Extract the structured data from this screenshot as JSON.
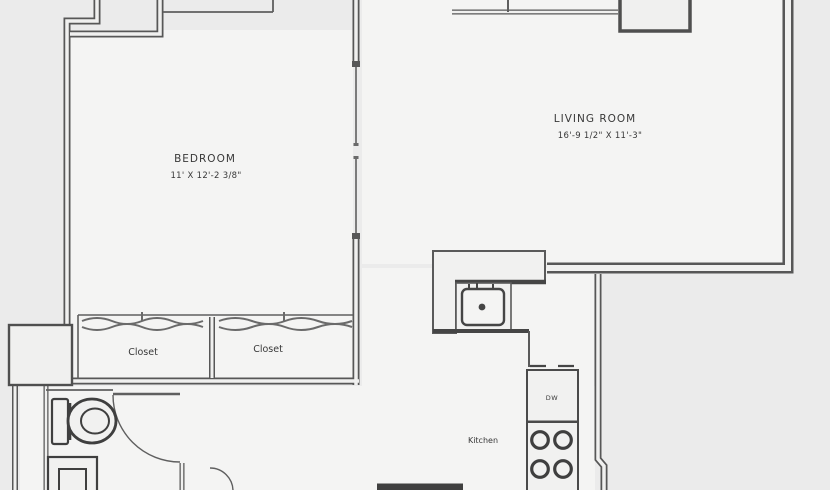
{
  "rooms": {
    "bedroom": {
      "label": "BEDROOM",
      "dimensions": "11' X 12'-2 3/8\""
    },
    "living_room": {
      "label": "LIVING ROOM",
      "dimensions": "16'-9 1/2\" X 11'-3\""
    },
    "closet_left": {
      "label": "Closet"
    },
    "closet_right": {
      "label": "Closet"
    },
    "kitchen": {
      "label": "Kitchen"
    }
  },
  "appliances": {
    "dishwasher_label": "DW"
  },
  "icons": [
    "toilet-icon",
    "pedestal-sink-icon",
    "kitchen-sink-icon",
    "faucet-icon",
    "stove-burners-icon",
    "dishwasher-icon",
    "closet-rod-icon",
    "door-swing-icon"
  ],
  "colors": {
    "background": "#ebebeb",
    "room_fill": "#f4f4f3",
    "wall": "#575757",
    "fixture": "#3f3f3f",
    "text": "#383838"
  }
}
